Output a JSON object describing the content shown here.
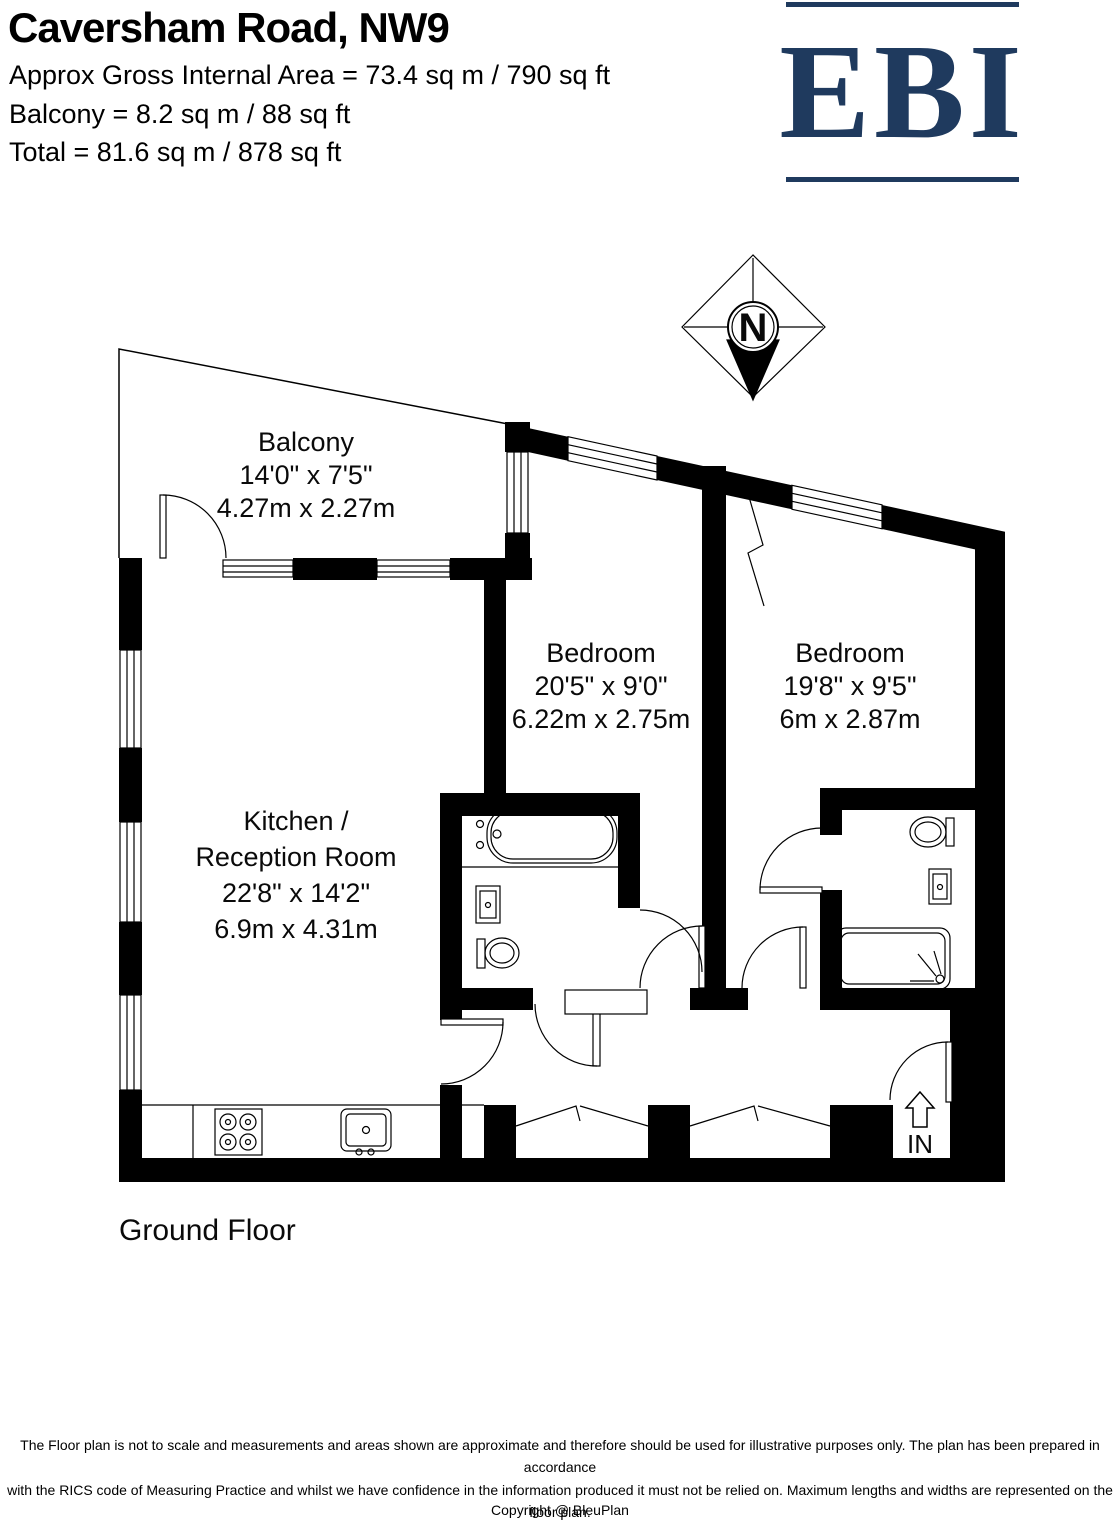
{
  "header": {
    "title": "Caversham Road, NW9",
    "area_line_1": "Approx Gross Internal Area = 73.4 sq m / 790 sq ft",
    "area_line_2": "Balcony = 8.2 sq m / 88 sq ft",
    "area_line_3": "Total = 81.6 sq m / 878 sq ft"
  },
  "logo": {
    "text": "EBI",
    "color": "#1f3a5e"
  },
  "compass": {
    "label": "N"
  },
  "plan": {
    "floor_label": "Ground Floor",
    "entrance_label": "IN",
    "rooms": [
      {
        "name": "Balcony",
        "imperial": "14'0\" x 7'5\"",
        "metric": "4.27m x 2.27m"
      },
      {
        "name": "Bedroom",
        "imperial": "20'5\" x 9'0\"",
        "metric": "6.22m x 2.75m"
      },
      {
        "name": "Bedroom",
        "imperial": "19'8\" x 9'5\"",
        "metric": "6m x 2.87m"
      },
      {
        "name": "Kitchen /",
        "name2": "Reception Room",
        "imperial": "22'8\" x 14'2\"",
        "metric": "6.9m x 4.31m"
      }
    ]
  },
  "footer": {
    "disclaimer_line_1": "The Floor plan is not to scale and measurements and areas shown are approximate and therefore should be used for illustrative purposes only. The plan has been prepared in accordance",
    "disclaimer_line_2": "with the RICS code of Measuring Practice and whilst we have confidence in the information produced it must not be relied on. Maximum lengths and widths are represented on the floor plan.",
    "disclaimer_line_3": "If there is any aspect of particular importance, you should carry out or commission your own inspection of the property.",
    "copyright": "Copyright @ BleuPlan"
  }
}
